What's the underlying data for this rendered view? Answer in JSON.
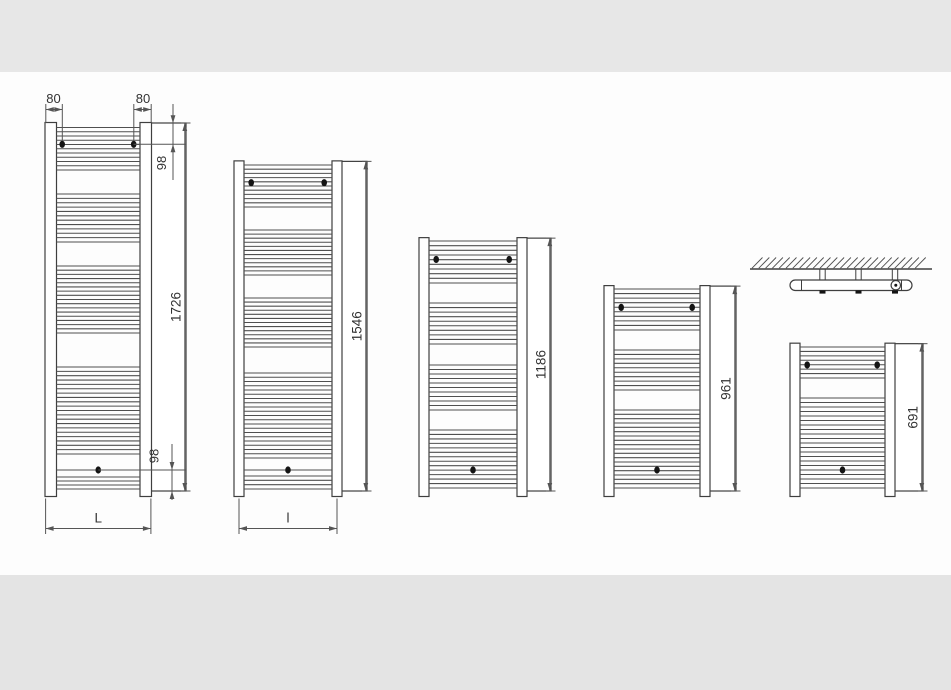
{
  "diagram": {
    "radiators": [
      {
        "model_height_mm": 1726,
        "labels": {
          "height": "1726",
          "top_offset": "98",
          "bottom_offset": "98",
          "left_inset": "80",
          "right_inset": "80",
          "width": "L"
        }
      },
      {
        "model_height_mm": 1546,
        "labels": {
          "height": "1546",
          "width": "l"
        }
      },
      {
        "model_height_mm": 1186,
        "labels": {
          "height": "1186"
        }
      },
      {
        "model_height_mm": 961,
        "labels": {
          "height": "961"
        }
      },
      {
        "model_height_mm": 691,
        "labels": {
          "height": "691"
        }
      }
    ]
  },
  "colors": {
    "canvas": "#fdfdfd",
    "top_band": "#e7e7e7",
    "bottom_band": "#e4e4e4",
    "line": "#3f3f3f",
    "rung": "#4f4f4f",
    "dim": "#555555",
    "text": "#333333",
    "dot": "#141414"
  }
}
